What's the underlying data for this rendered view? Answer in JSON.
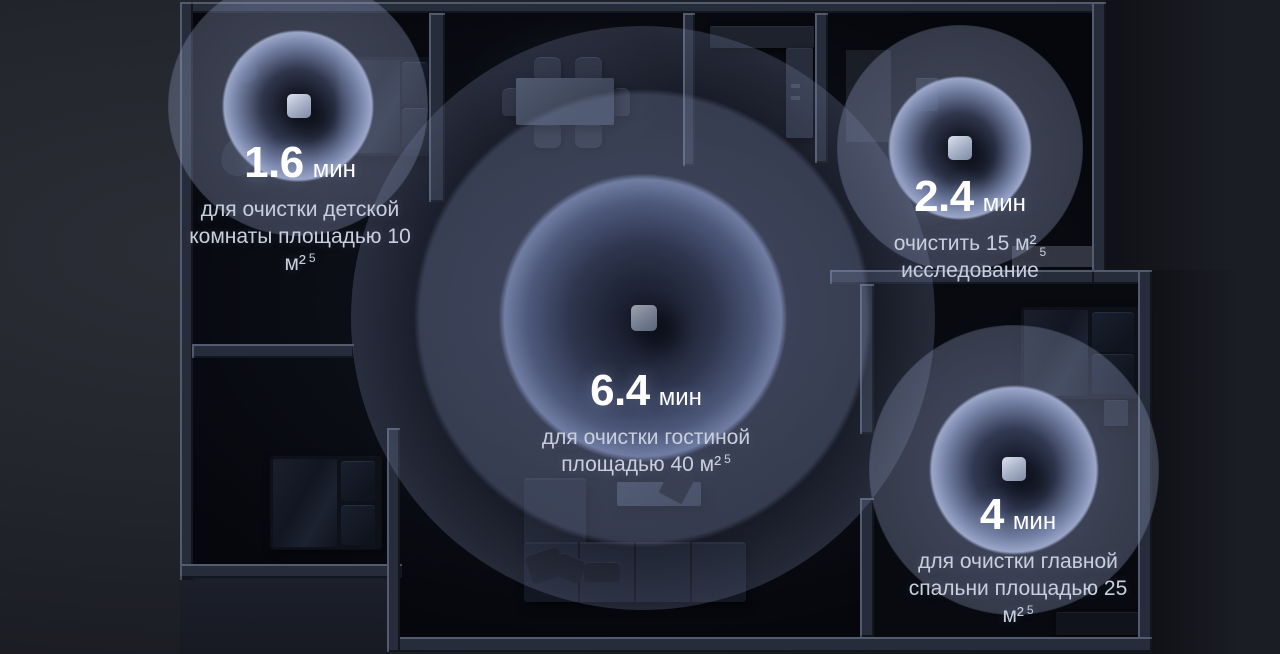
{
  "rooms": [
    {
      "name": "nursery",
      "time_value": "1.6",
      "time_unit": "мин",
      "line1": "для очистки детской",
      "line2": "комнаты площадью 10",
      "line3": "м²",
      "footnote": "5"
    },
    {
      "name": "study",
      "time_value": "2.4",
      "time_unit": "мин",
      "line1": "очистить 15 м²",
      "line2": "исследование",
      "footnote": "5"
    },
    {
      "name": "living-room",
      "time_value": "6.4",
      "time_unit": "мин",
      "line1": "для очистки гостиной",
      "line2": "площадью 40 м²",
      "footnote": "5"
    },
    {
      "name": "master-bedroom",
      "time_value": "4",
      "time_unit": "мин",
      "line1": "для очистки главной",
      "line2": "спальни площадью 25",
      "line3": "м²",
      "footnote": "5"
    }
  ],
  "colors": {
    "background": "#23262d",
    "floor": "#0b0d13",
    "wall": "#262c3a",
    "wall_edge": "#848ea8",
    "pulse_glow": "#9aa8cc",
    "text_primary": "#ffffff",
    "text_secondary": "#c9cfdc"
  },
  "device": {
    "icon": "purifier-cube"
  }
}
